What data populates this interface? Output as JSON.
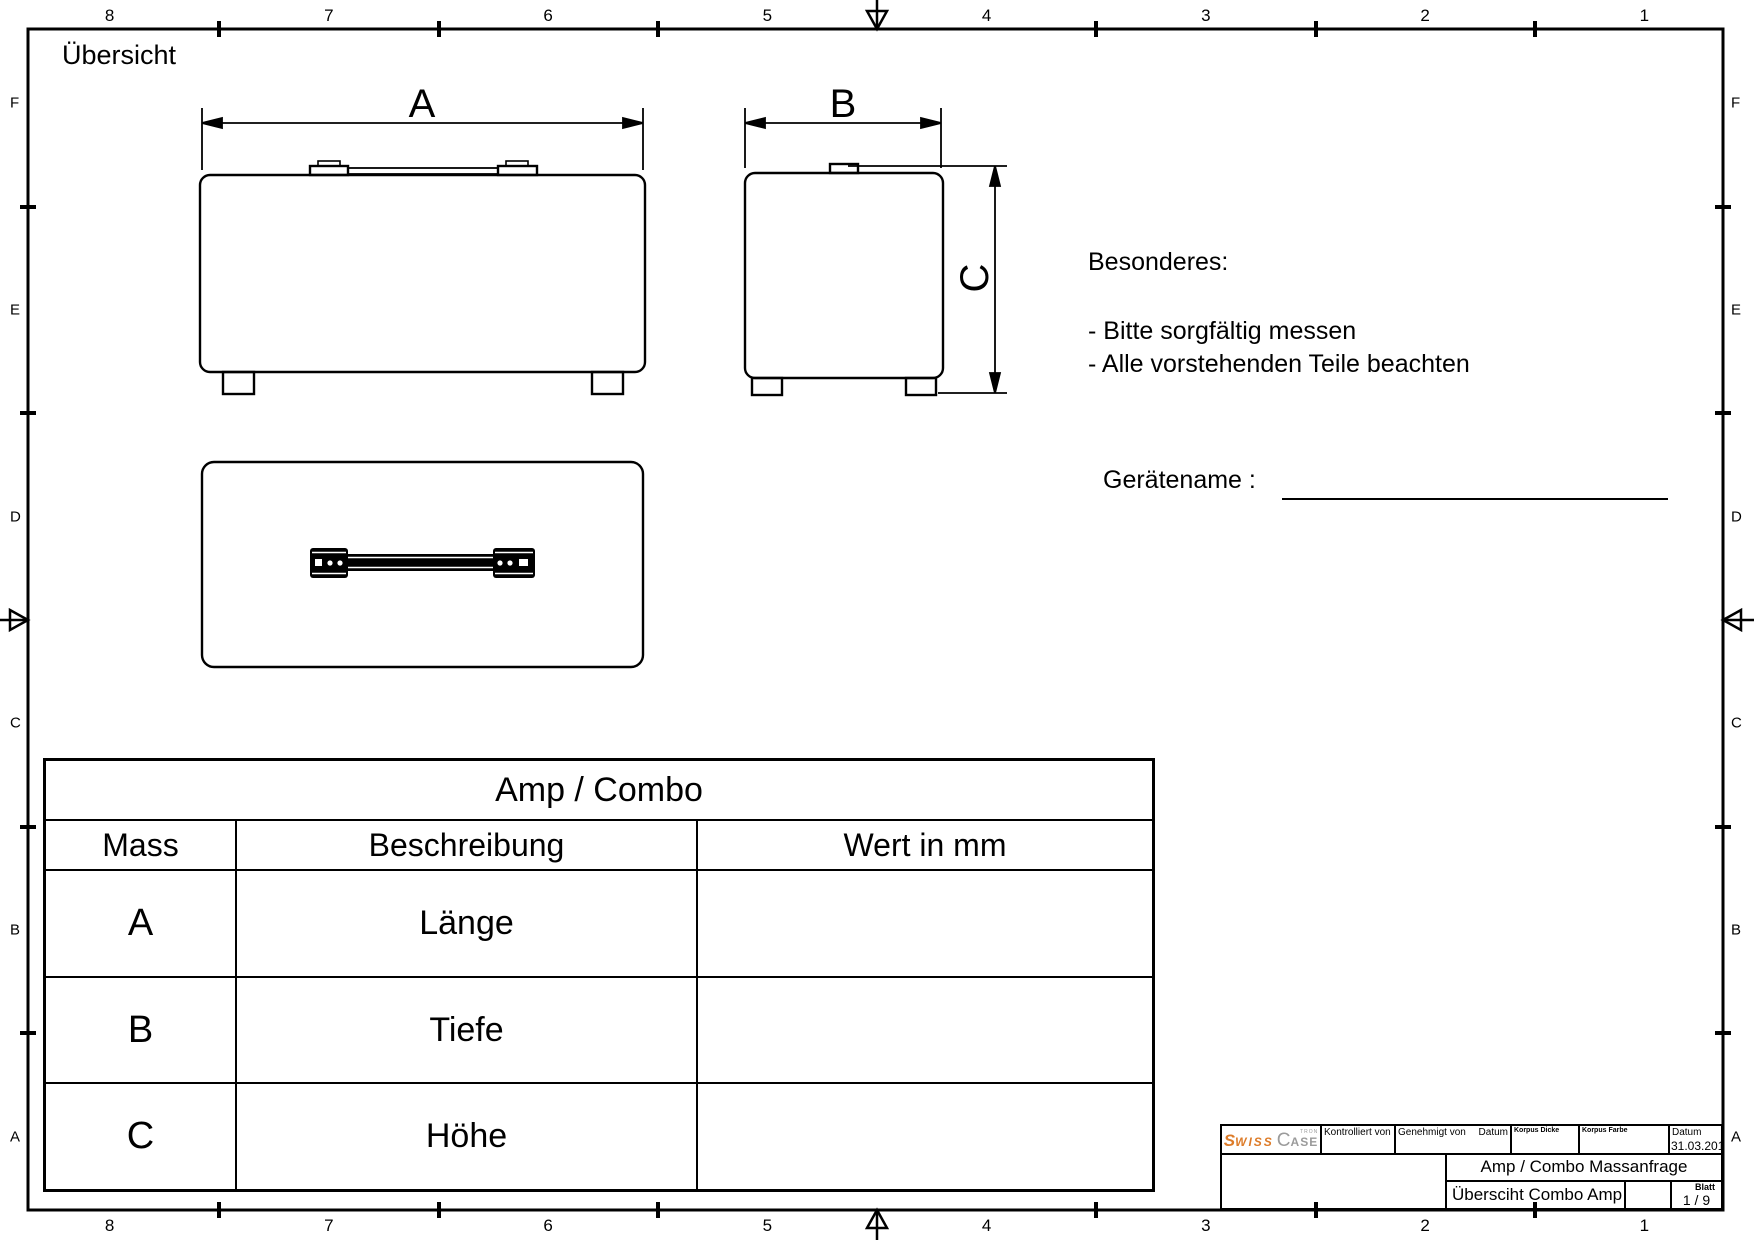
{
  "page": {
    "title": "Übersicht"
  },
  "zones": {
    "columns": [
      "8",
      "7",
      "6",
      "5",
      "4",
      "3",
      "2",
      "1"
    ],
    "rows": [
      "F",
      "E",
      "D",
      "C",
      "B",
      "A"
    ]
  },
  "views": {
    "front": {
      "dim_label": "A"
    },
    "side": {
      "width_label": "B",
      "height_label": "C"
    }
  },
  "notes": {
    "heading": "Besonderes:",
    "items": [
      "- Bitte sorgfältig messen",
      "- Alle vorstehenden Teile beachten"
    ]
  },
  "device_name": {
    "label": "Gerätename :",
    "value": ""
  },
  "table": {
    "title": "Amp / Combo",
    "headers": {
      "mass": "Mass",
      "beschreibung": "Beschreibung",
      "wert": "Wert in mm"
    },
    "rows": [
      {
        "mass": "A",
        "beschreibung": "Länge",
        "wert": ""
      },
      {
        "mass": "B",
        "beschreibung": "Tiefe",
        "wert": ""
      },
      {
        "mass": "C",
        "beschreibung": "Höhe",
        "wert": ""
      }
    ]
  },
  "title_block": {
    "logo": {
      "part1": "S",
      "part2": "WISS",
      "part3": "C",
      "part4": "ASE",
      "part5": "TRON"
    },
    "kontrolliert_label": "Kontrolliert von",
    "genehmigt_label": "Genehmigt von",
    "datum_label": "Datum",
    "korpus_dicke_label": "Korpus Dicke",
    "korpus_farbe_label": "Korpus Farbe",
    "datum_value": "31.03.2010",
    "project_title": "Amp / Combo Massanfrage",
    "sheet_title": "Übersciht Combo Amp",
    "blatt_label": "Blatt",
    "blatt_value": "1 / 9"
  },
  "colors": {
    "line": "#000000",
    "logo_orange": "#dd7b28",
    "logo_gray": "#9b9b9b"
  }
}
